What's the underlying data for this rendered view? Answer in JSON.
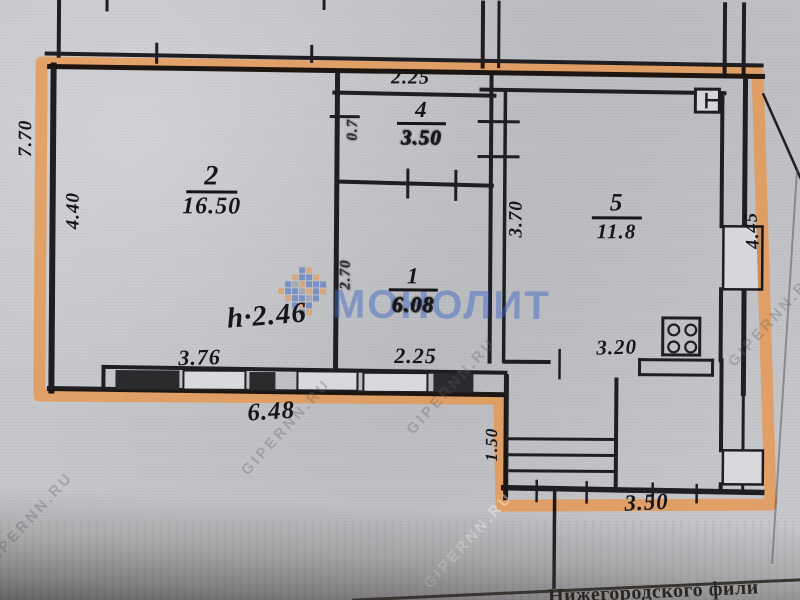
{
  "document": {
    "kind": "scanned floor plan photo",
    "footer_text": "Нижегородского фили"
  },
  "watermarks": {
    "logo_text": "МОНОЛИТ",
    "site_text": "GIPERNN.RU"
  },
  "rooms": [
    {
      "number": "2",
      "area": "16.50"
    },
    {
      "number": "4",
      "area": "3.50"
    },
    {
      "number": "1",
      "area": "6.08"
    },
    {
      "number": "5",
      "area": "11.8"
    }
  ],
  "dimensions": {
    "left_total": "7.70",
    "room2_left": "4.40",
    "room4_top": "2.25",
    "room4_door": "0.7",
    "room1_left": "2.70",
    "room5_left": "3.70",
    "right_total": "4.45",
    "ceiling_height": "h·2.46",
    "room2_bottom": "3.76",
    "room1_bottom": "2.25",
    "bottom_total": "6.48",
    "kitchen_bottom": "3.20",
    "porch_left": "1.50",
    "porch_bottom": "3.50"
  },
  "icons": {
    "stove": "gas-stove",
    "panel": "electric-panel"
  },
  "colors": {
    "highlight_orange": "#e8944a",
    "ink": "#15151a",
    "watermark_blue": "#3e68c4",
    "paper": "#c6c7cb"
  }
}
